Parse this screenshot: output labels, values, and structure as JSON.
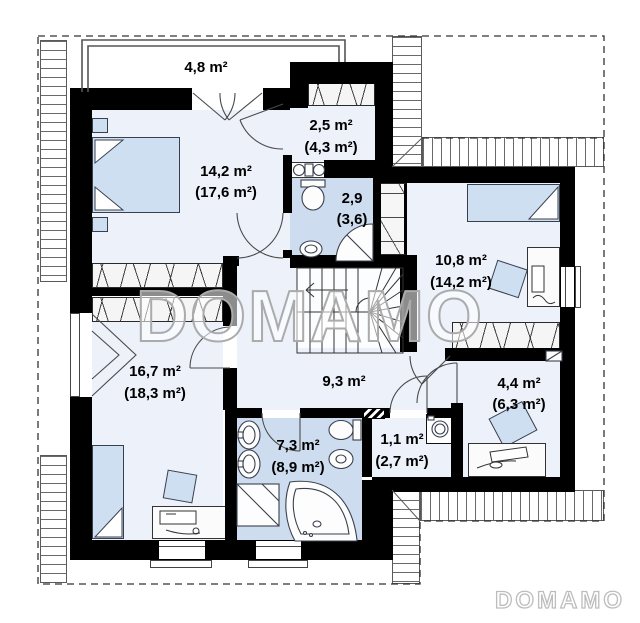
{
  "plan_type": "floor-plan",
  "watermark": {
    "center": "DOMAMO",
    "corner": "DOMAMO"
  },
  "colors": {
    "wall": "#000000",
    "room_fill": "#ecf1fa",
    "bathroom_fill": "#cddcee",
    "furniture_fill": "#cfdff2",
    "watermark_stroke": "#ababab"
  },
  "rooms": [
    {
      "name": "terrace",
      "label": "4,8 m²",
      "sublabel": ""
    },
    {
      "name": "bedroom-1",
      "label": "14,2 m²",
      "sublabel": "(17,6 m²)"
    },
    {
      "name": "wardrobe",
      "label": "2,5 m²",
      "sublabel": "(4,3 m²)"
    },
    {
      "name": "bathroom-small",
      "label": "2,9",
      "sublabel": "(3,6)"
    },
    {
      "name": "bedroom-2",
      "label": "10,8 m²",
      "sublabel": "(14,2 m²)"
    },
    {
      "name": "bedroom-3",
      "label": "16,7 m²",
      "sublabel": "(18,3 m²)"
    },
    {
      "name": "hall",
      "label": "9,3 m²",
      "sublabel": ""
    },
    {
      "name": "office",
      "label": "4,4 m²",
      "sublabel": "(6,3 m²)"
    },
    {
      "name": "bathroom",
      "label": "7,3 m²",
      "sublabel": "(8,9 m²)"
    },
    {
      "name": "utility",
      "label": "1,1 m²",
      "sublabel": "(2,7 m²)"
    }
  ]
}
